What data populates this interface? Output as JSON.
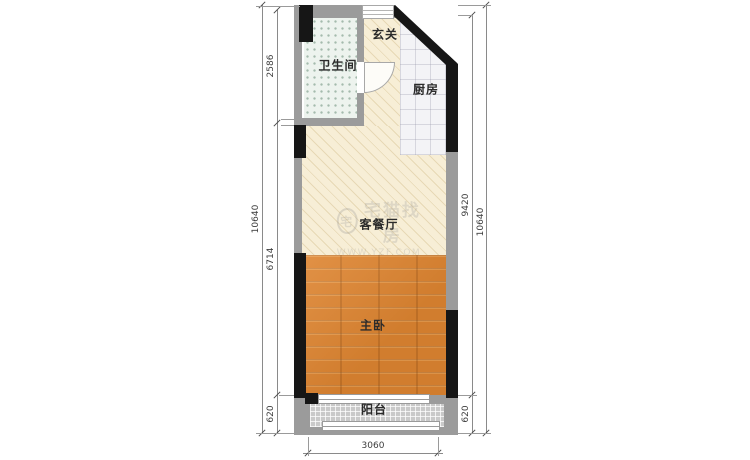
{
  "rooms": [
    {
      "id": "foyer",
      "label": "玄关"
    },
    {
      "id": "bathroom",
      "label": "卫生间"
    },
    {
      "id": "kitchen",
      "label": "厨房"
    },
    {
      "id": "living-dining",
      "label": "客餐厅"
    },
    {
      "id": "master-bedroom",
      "label": "主卧"
    },
    {
      "id": "balcony",
      "label": "阳台"
    }
  ],
  "dims": {
    "left_inner": [
      "2586",
      "6714",
      "620"
    ],
    "left_outer": "10640",
    "right_inner": [
      "9420",
      "620"
    ],
    "right_outer": "10640",
    "bottom": "3060"
  },
  "watermark": {
    "logo_char": "宅",
    "text": "宅猫找房",
    "url": "WWW.YZF.COM"
  },
  "colors": {
    "wall_black": "#161616",
    "wall_gray": "#9b9b9b",
    "wood_floor": "#de8531",
    "cream_floor": "#f7eed6",
    "bath_tile": "#edf3ee",
    "kitchen_tile": "#f3f3f6",
    "balcony_tile": "#c9c9c9",
    "dim_line": "#8a8a8a"
  }
}
